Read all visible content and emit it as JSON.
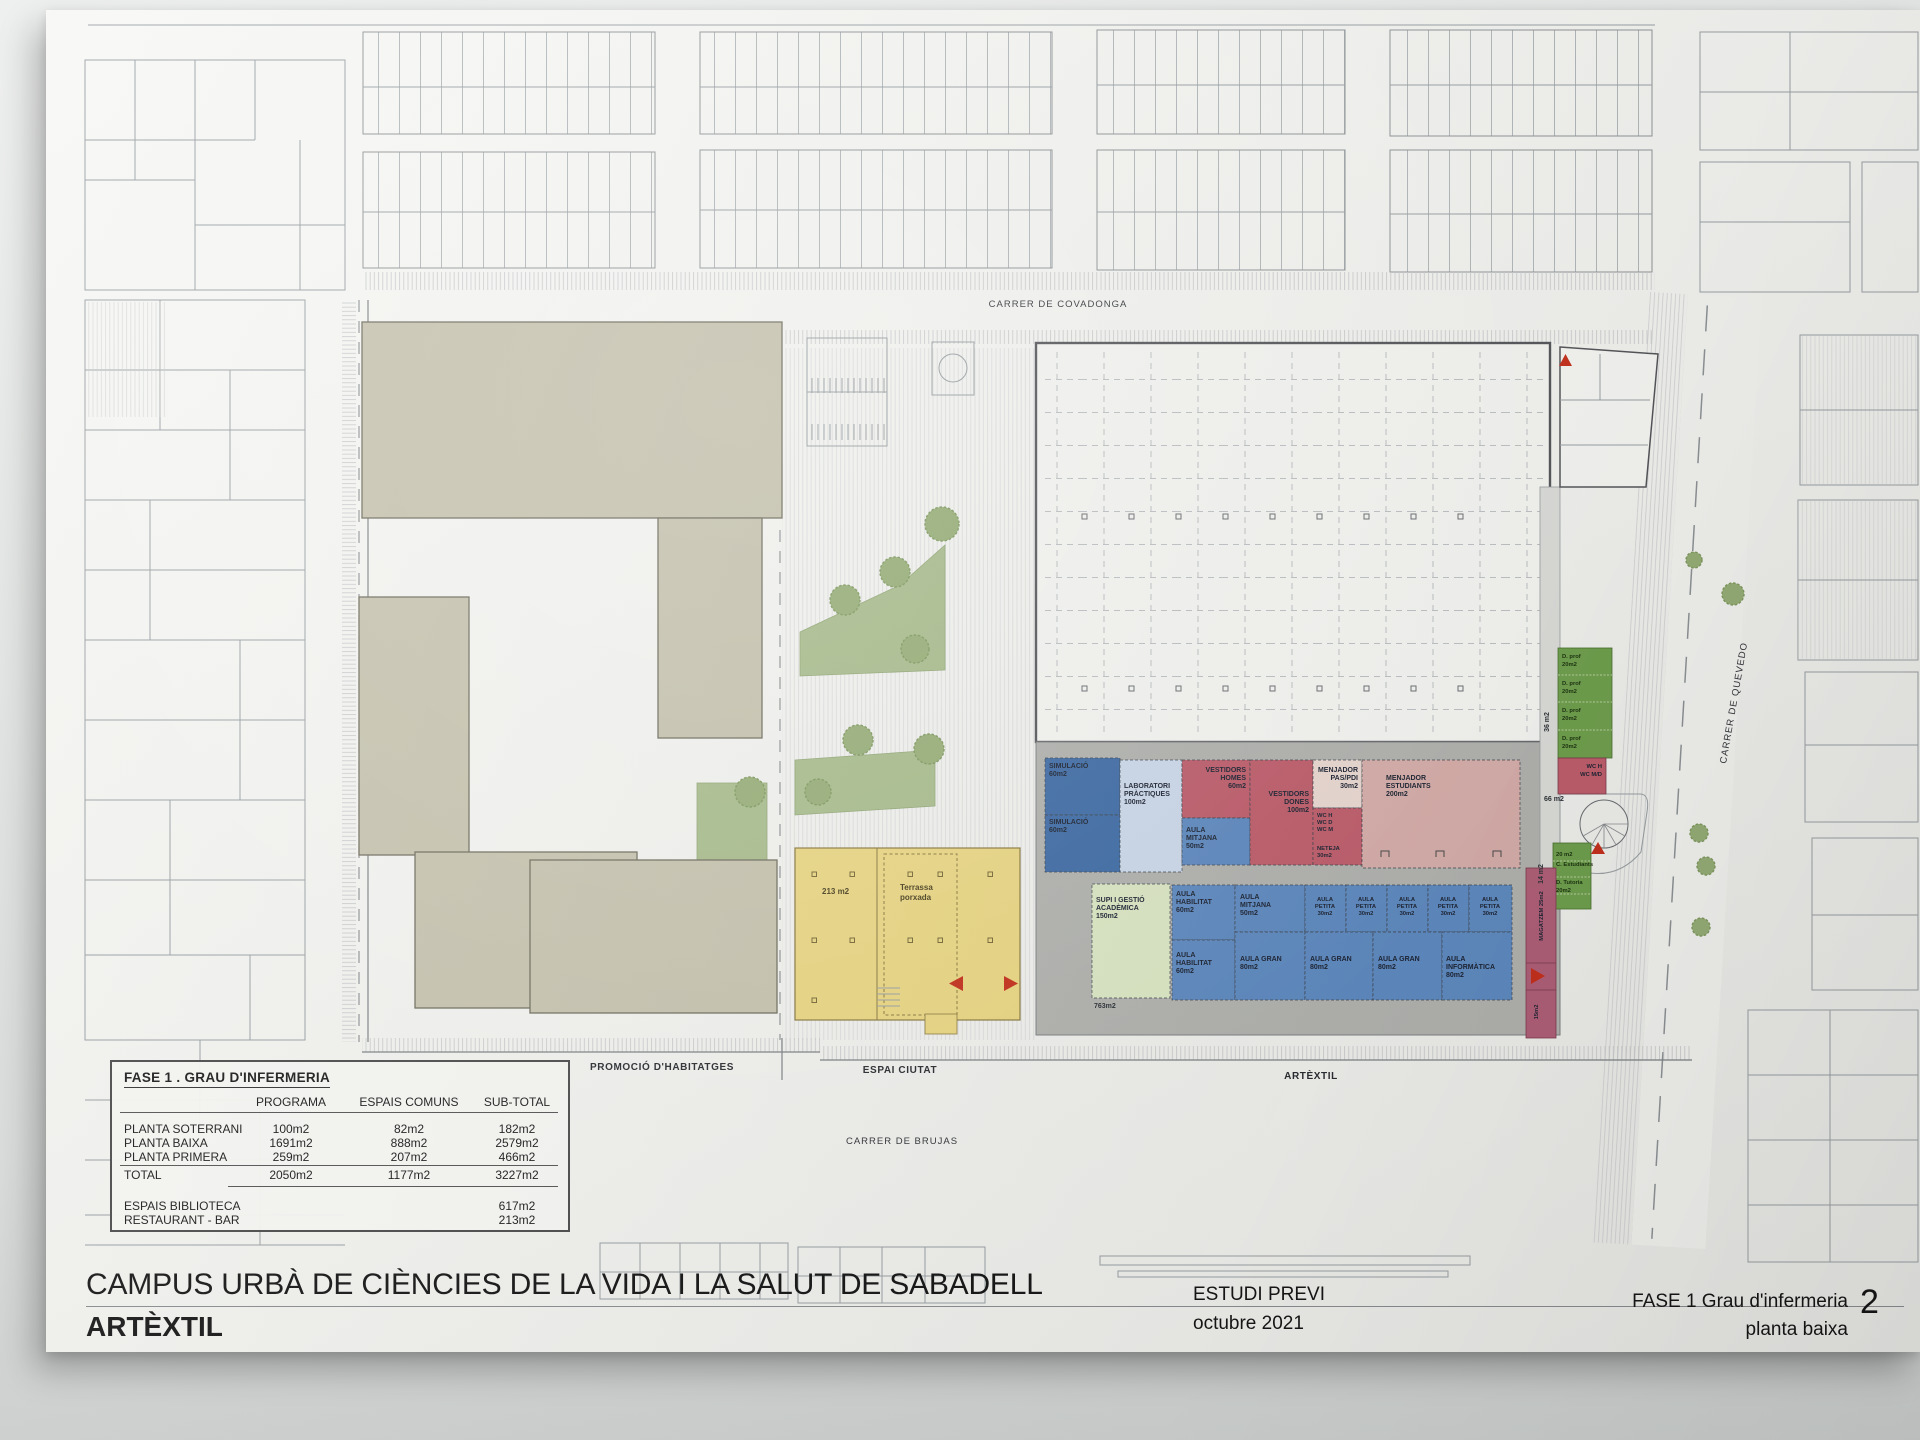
{
  "titleblock": {
    "project_title": "CAMPUS URBÀ DE CIÈNCIES DE LA VIDA I LA SALUT DE SABADELL",
    "building_name": "ARTÈXTIL",
    "stage": "ESTUDI PREVI",
    "date": "octubre 2021",
    "phase": "FASE 1 Grau d'infermeria",
    "sheet_title": "planta baixa",
    "sheet_number": "2"
  },
  "streets": {
    "top": "CARRER DE COVADONGA",
    "right": "CARRER DE QUEVEDO",
    "bottom": "CARRER DE BRUJAS"
  },
  "zones": {
    "left": "PROMOCIÓ D'HABITATGES",
    "center": "ESPAI CIUTAT",
    "right": "ARTÈXTIL"
  },
  "area_table": {
    "title": "FASE 1 . GRAU D'INFERMERIA",
    "columns": [
      "PROGRAMA",
      "ESPAIS COMUNS",
      "SUB-TOTAL"
    ],
    "rows": [
      {
        "label": "PLANTA SOTERRANI",
        "programa": "100m2",
        "espais": "82m2",
        "subtotal": "182m2"
      },
      {
        "label": "PLANTA BAIXA",
        "programa": "1691m2",
        "espais": "888m2",
        "subtotal": "2579m2"
      },
      {
        "label": "PLANTA PRIMERA",
        "programa": "259m2",
        "espais": "207m2",
        "subtotal": "466m2"
      },
      {
        "label": "TOTAL",
        "programa": "2050m2",
        "espais": "1177m2",
        "subtotal": "3227m2"
      }
    ],
    "extra_rows": [
      {
        "label": "ESPAIS BIBLIOTECA",
        "subtotal": "617m2"
      },
      {
        "label": "RESTAURANT - BAR",
        "subtotal": "213m2"
      }
    ]
  },
  "rooms": {
    "top_band": [
      {
        "name": "simulacio-1",
        "lines": [
          "SIMULACIÓ",
          "60m2"
        ]
      },
      {
        "name": "simulacio-2",
        "lines": [
          "SIMULACIÓ",
          "60m2"
        ]
      },
      {
        "name": "laboratori-practiques",
        "lines": [
          "LABORATORI",
          "PRÀCTIQUES",
          "100m2"
        ]
      },
      {
        "name": "vestidors-homes",
        "lines": [
          "VESTIDORS",
          "HOMES",
          "60m2"
        ]
      },
      {
        "name": "aula-mitjana",
        "lines": [
          "AULA",
          "MITJANA",
          "50m2"
        ]
      },
      {
        "name": "vestidors-dones",
        "lines": [
          "VESTIDORS",
          "DONES",
          "100m2"
        ]
      },
      {
        "name": "menjador-pas-pdi",
        "lines": [
          "MENJADOR",
          "PAS/PDI",
          "30m2"
        ]
      },
      {
        "name": "wc-block",
        "lines": [
          "WC H",
          "WC D",
          "WC M"
        ]
      },
      {
        "name": "neteja",
        "lines": [
          "NETEJA",
          "30m2"
        ]
      },
      {
        "name": "menjador-estudiants",
        "lines": [
          "MENJADOR",
          "ESTUDIANTS",
          "200m2"
        ]
      }
    ],
    "bottom_band": [
      {
        "name": "supi-gestio-academica",
        "lines": [
          "SUPI I GESTIÓ",
          "ACADÈMICA",
          "150m2"
        ]
      },
      {
        "name": "aula-habilitat-1",
        "lines": [
          "AULA",
          "HABILITAT",
          "60m2"
        ]
      },
      {
        "name": "aula-mitjana-2",
        "lines": [
          "AULA",
          "MITJANA",
          "50m2"
        ]
      },
      {
        "name": "aula-petita-1",
        "lines": [
          "AULA",
          "PETITA",
          "30m2"
        ]
      },
      {
        "name": "aula-petita-2",
        "lines": [
          "AULA",
          "PETITA",
          "30m2"
        ]
      },
      {
        "name": "aula-petita-3",
        "lines": [
          "AULA",
          "PETITA",
          "30m2"
        ]
      },
      {
        "name": "aula-petita-4",
        "lines": [
          "AULA",
          "PETITA",
          "30m2"
        ]
      },
      {
        "name": "aula-petita-5",
        "lines": [
          "AULA",
          "PETITA",
          "30m2"
        ]
      },
      {
        "name": "aula-habilitat-2",
        "lines": [
          "AULA",
          "HABILITAT",
          "60m2"
        ]
      },
      {
        "name": "aula-gran-1",
        "lines": [
          "AULA GRAN",
          "80m2"
        ]
      },
      {
        "name": "aula-gran-2",
        "lines": [
          "AULA GRAN",
          "80m2"
        ]
      },
      {
        "name": "aula-gran-3",
        "lines": [
          "AULA GRAN",
          "80m2"
        ]
      },
      {
        "name": "aula-informatica",
        "lines": [
          "AULA",
          "INFORMÀTICA",
          "80m2"
        ]
      }
    ],
    "east_wing": [
      {
        "name": "despatx-prof-1",
        "lines": [
          "D. prof",
          "20m2"
        ]
      },
      {
        "name": "despatx-prof-2",
        "lines": [
          "D. prof",
          "20m2"
        ]
      },
      {
        "name": "despatx-prof-3",
        "lines": [
          "D. prof",
          "20m2"
        ]
      },
      {
        "name": "despatx-prof-4",
        "lines": [
          "D. prof",
          "20m2"
        ]
      },
      {
        "name": "wc-wing",
        "lines": [
          "WC H",
          "WC M/D"
        ]
      },
      {
        "name": "consell-estudiants",
        "lines": [
          "20 m2",
          "C. Estudiants"
        ]
      },
      {
        "name": "despatx-tutoria",
        "lines": [
          "D. Tutoria",
          "20m2"
        ]
      }
    ]
  },
  "labels": {
    "yellow_area": "213 m2",
    "terrassa": [
      "Terrassa",
      "porxada"
    ],
    "slab_area": "763m2",
    "area_36": "36 m2",
    "area_66": "66 m2",
    "area_14": "14 m2",
    "magatzem": "MAGATZEM 25m2",
    "magatzem_2": "15m2"
  }
}
